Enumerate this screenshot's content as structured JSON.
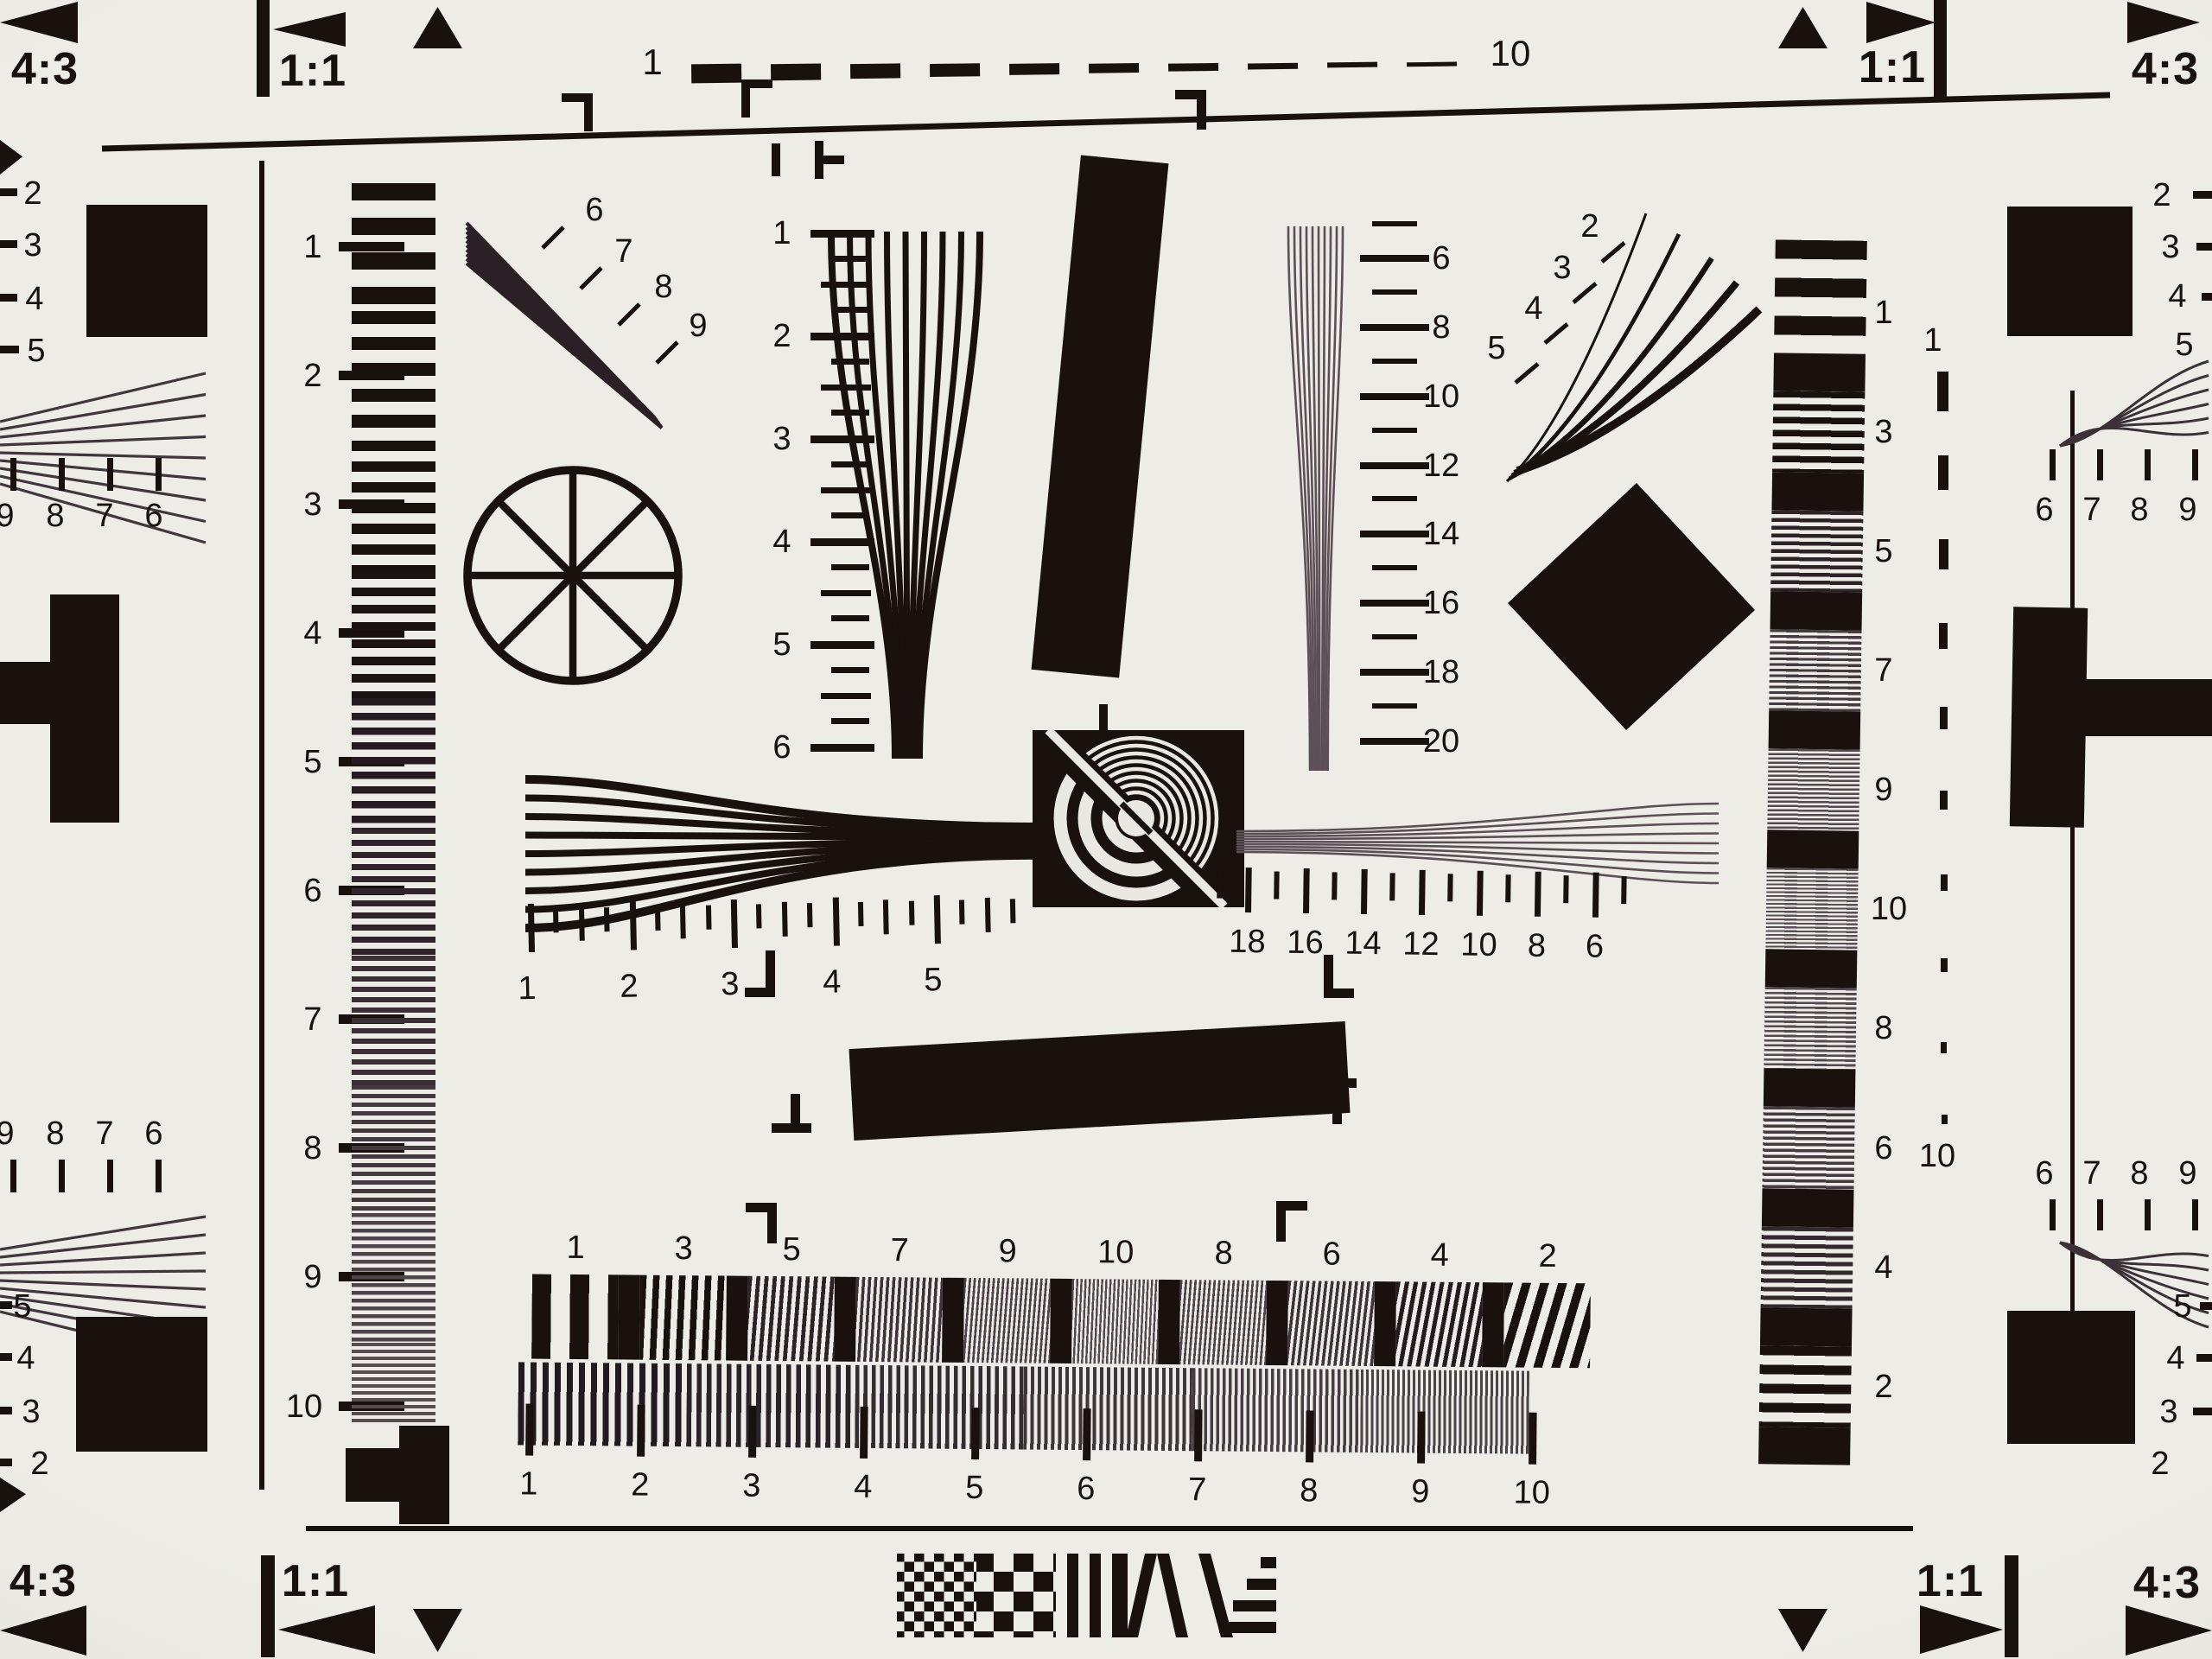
{
  "colors": {
    "paper": "#e9e8e2",
    "ink": "#18110e",
    "fine_pattern": "#5c4f57"
  },
  "corner_marks": {
    "top_left": {
      "ratio": "4:3",
      "aspect": "1:1"
    },
    "top_right": {
      "aspect": "1:1",
      "ratio": "4:3"
    },
    "bottom_left": {
      "ratio": "4:3",
      "aspect": "1:1"
    },
    "bottom_right": {
      "aspect": "1:1",
      "ratio": "4:3"
    }
  },
  "top_dash_scale": {
    "start_label": "1",
    "end_label": "10"
  },
  "right_dash_scale": {
    "start_label": "1",
    "end_label": "10"
  },
  "left_ruler": {
    "labels": [
      "1",
      "2",
      "3",
      "4",
      "5",
      "6",
      "7",
      "8",
      "9",
      "10"
    ]
  },
  "center_wedge_scale": {
    "labels": [
      "1",
      "2",
      "3",
      "4",
      "5",
      "6"
    ]
  },
  "diagonal_wedge_scale": {
    "labels": [
      "6",
      "7",
      "8",
      "9"
    ]
  },
  "upper_right_fan_scale": {
    "labels": [
      "2",
      "3",
      "4",
      "5"
    ]
  },
  "right_wedge_scale": {
    "labels": [
      "6",
      "8",
      "10",
      "12",
      "14",
      "16",
      "18",
      "20"
    ]
  },
  "center_left_ruler": {
    "labels": [
      "1",
      "2",
      "3",
      "4",
      "5"
    ]
  },
  "center_right_ruler": {
    "labels": [
      "18",
      "16",
      "14",
      "12",
      "10",
      "8",
      "6"
    ]
  },
  "right_column_scale": {
    "labels": [
      "1",
      "3",
      "5",
      "7",
      "9",
      "10",
      "8",
      "6",
      "4",
      "2"
    ]
  },
  "bottom_band_top_scale": {
    "labels": [
      "1",
      "3",
      "5",
      "7",
      "9",
      "10",
      "8",
      "6",
      "4",
      "2"
    ]
  },
  "bottom_ruler": {
    "labels": [
      "1",
      "2",
      "3",
      "4",
      "5",
      "6",
      "7",
      "8",
      "9",
      "10"
    ]
  },
  "left_edge": {
    "top_cut_numbers": [
      "2",
      "3",
      "4",
      "5"
    ],
    "top_tick_numbers": [
      "9",
      "8",
      "7",
      "6"
    ],
    "bottom_tick_numbers": [
      "9",
      "8",
      "7",
      "6"
    ],
    "bottom_cut_numbers": [
      "5",
      "4",
      "3",
      "2"
    ]
  },
  "right_edge": {
    "top_cut_numbers": [
      "2",
      "3",
      "4",
      "5"
    ],
    "top_tick_numbers": [
      "6",
      "7",
      "8",
      "9"
    ],
    "bottom_tick_numbers": [
      "6",
      "7",
      "8",
      "9"
    ],
    "bottom_cut_numbers": [
      "5",
      "4",
      "3",
      "2"
    ]
  }
}
